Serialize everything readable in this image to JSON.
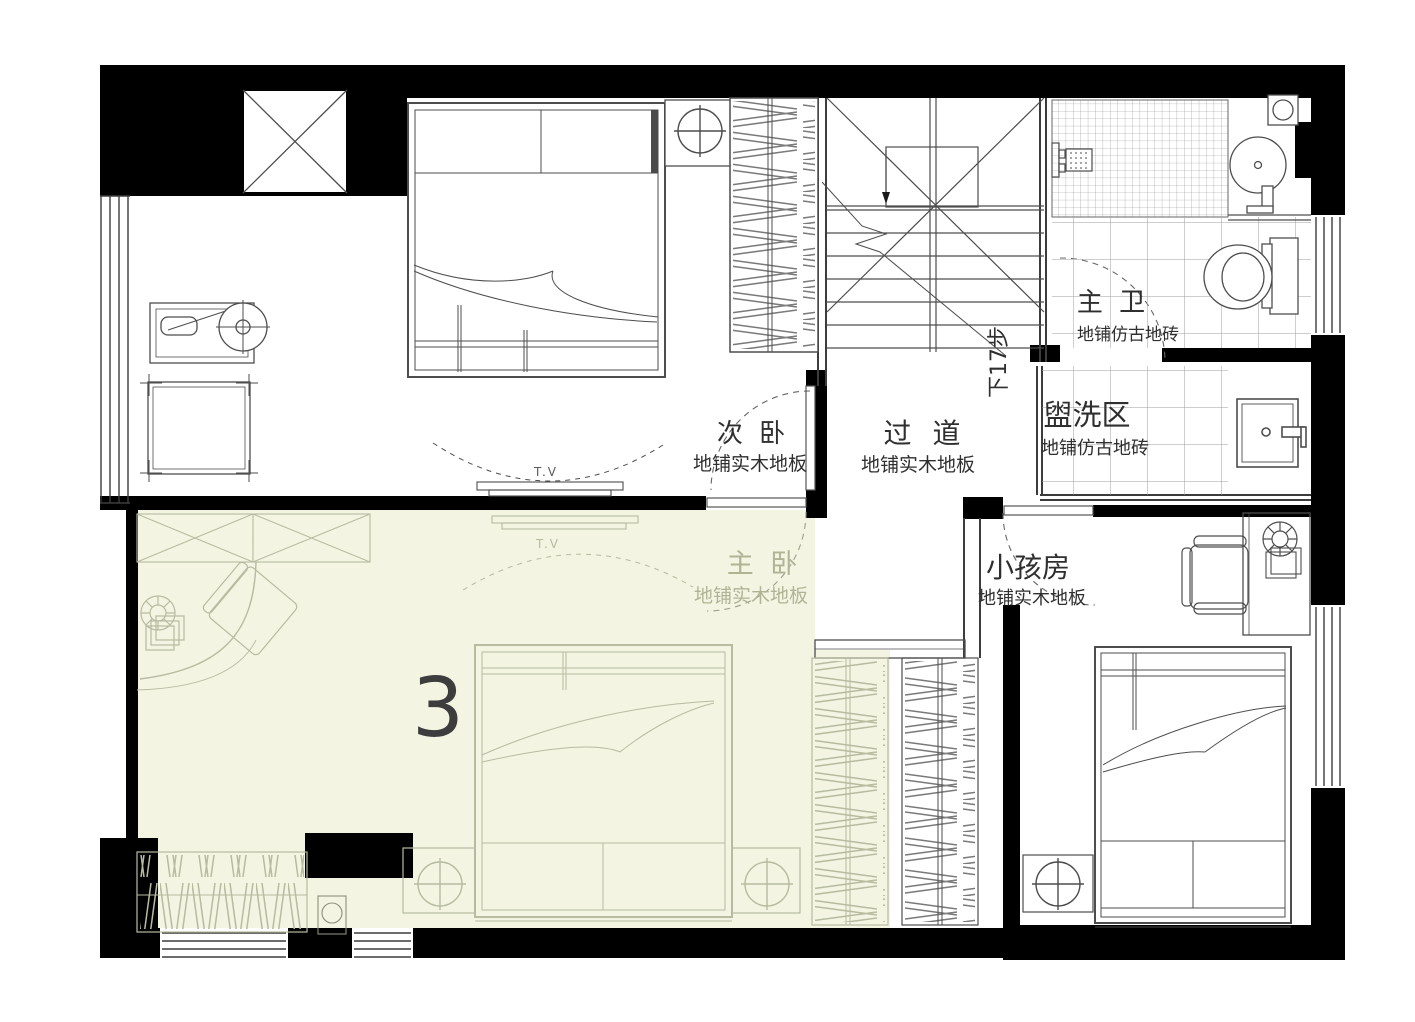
{
  "plan": {
    "unit_label": "3",
    "stair_note": "下17步",
    "tv_label": "T.V",
    "rooms": [
      {
        "id": "secondary-bedroom",
        "name": "次 卧",
        "floor": "地铺实木地板"
      },
      {
        "id": "corridor",
        "name": "过 道",
        "floor": "地铺实木地板"
      },
      {
        "id": "master-bath",
        "name": "主 卫",
        "floor": "地铺仿古地砖"
      },
      {
        "id": "wash-area",
        "name": "盥洗区",
        "floor": "地铺仿古地砖"
      },
      {
        "id": "master-bedroom",
        "name": "主 卧",
        "floor": "地铺实木地板"
      },
      {
        "id": "kids-room",
        "name": "小孩房",
        "floor": "地铺实木地板"
      }
    ],
    "colors": {
      "highlight": "#f3f5e2",
      "wall": "#000000",
      "line": "#4d4d4d",
      "pale_line": "#b7bba0",
      "label": "#2f2f2f",
      "pale_label": "#b0b495",
      "unit_number": "#3d3d3d"
    }
  }
}
